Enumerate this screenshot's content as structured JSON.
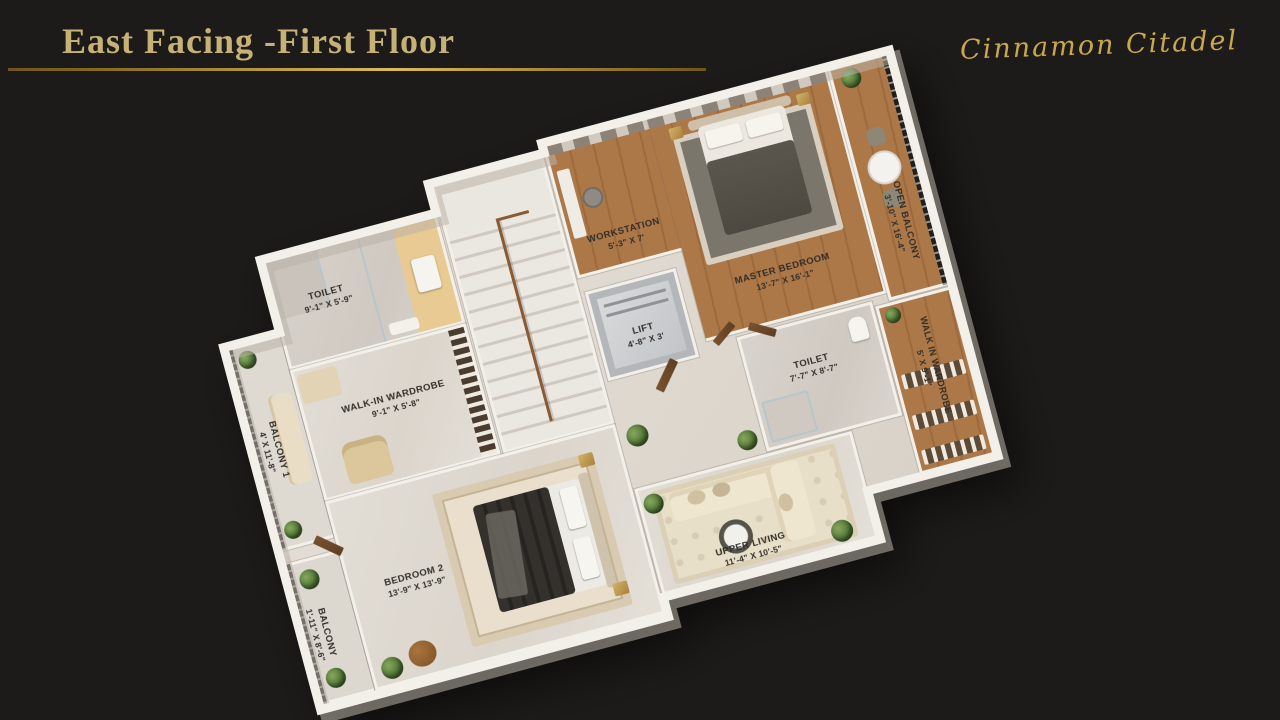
{
  "page": {
    "background_color": "#1d1b1a"
  },
  "header": {
    "title": "East Facing -First Floor",
    "title_color": "#c6b276",
    "underline_gradient": [
      "#6e5519",
      "#dcbc58",
      "#8a6d24"
    ]
  },
  "brand": {
    "name": "Cinnamon Citadel",
    "color": "#c9a84c"
  },
  "floorplan": {
    "view": "3d-isometric-top",
    "rotation_deg": -15,
    "palette": {
      "wood_floor": "#a9744a",
      "marble_floor": "#e0dbd3",
      "wall": "#f3f0ea",
      "railing": "#1f1c19",
      "label_text": "#322e29"
    },
    "rooms": [
      {
        "id": "master-bedroom",
        "name": "Master Bedroom",
        "dims": "13'-7\" X 16'-1\""
      },
      {
        "id": "workstation",
        "name": "Workstation",
        "dims": "5'-3\" X 7'"
      },
      {
        "id": "open-balcony",
        "name": "Open Balcony",
        "dims": "3'-10\" X 16'-4\""
      },
      {
        "id": "walk-in-wardrobe-master",
        "name": "Walk In Wardrobe",
        "dims": "5' X 9'-1\""
      },
      {
        "id": "toilet-master",
        "name": "Toilet",
        "dims": "7'-7\" X 8'-7\""
      },
      {
        "id": "lift",
        "name": "Lift",
        "dims": "4'-8\" X 3'"
      },
      {
        "id": "toilet-2",
        "name": "Toilet",
        "dims": "9'-1\" X 5'-9\""
      },
      {
        "id": "walk-in-wardrobe-2",
        "name": "Walk-In Wardrobe",
        "dims": "9'-1\" X 5'-8\""
      },
      {
        "id": "balcony-1",
        "name": "Balcony 1",
        "dims": "4' X 11'-8\""
      },
      {
        "id": "bedroom-2",
        "name": "Bedroom 2",
        "dims": "13'-9\" X 13'-9\""
      },
      {
        "id": "upper-living",
        "name": "Upper Living",
        "dims": "11'-4\" X 10'-5\""
      },
      {
        "id": "balcony-2",
        "name": "Balcony",
        "dims": "1'-11\" X 8'-6\""
      }
    ]
  }
}
